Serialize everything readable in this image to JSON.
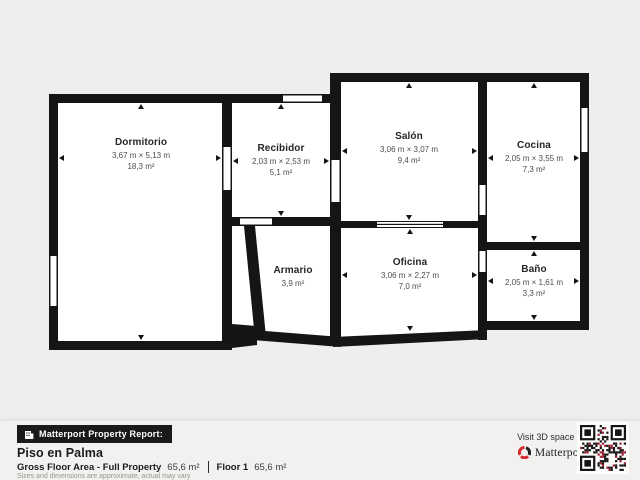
{
  "colors": {
    "background": "#efeeec",
    "wall": "#171514",
    "room_fill": "#ffffff",
    "brand_red": "#d7282f"
  },
  "rooms": [
    {
      "id": "dormitorio",
      "name": "Dormitorio",
      "dims": "3,67 m × 5,13 m",
      "area": "18,3 m²"
    },
    {
      "id": "recibidor",
      "name": "Recibidor",
      "dims": "2,03 m × 2,53 m",
      "area": "5,1 m²"
    },
    {
      "id": "salon",
      "name": "Salón",
      "dims": "3,06 m × 3,07 m",
      "area": "9,4 m²"
    },
    {
      "id": "cocina",
      "name": "Cocina",
      "dims": "2,05 m × 3,55 m",
      "area": "7,3 m²"
    },
    {
      "id": "armario",
      "name": "Armario",
      "dims": "",
      "area": "3,9 m²"
    },
    {
      "id": "oficina",
      "name": "Oficina",
      "dims": "3,06 m × 2,27 m",
      "area": "7,0 m²"
    },
    {
      "id": "bano",
      "name": "Baño",
      "dims": "2,05 m × 1,61 m",
      "area": "3,3 m²"
    }
  ],
  "footer": {
    "badge_label": "Matterport Property Report:",
    "title": "Piso en Palma",
    "gross_label": "Gross Floor Area - Full Property",
    "gross_value": "65,6 m²",
    "floor_label": "Floor 1",
    "floor_value": "65,6 m²",
    "disclaimer": "Sizes and dimensions are approximate, actual may vary",
    "visit_text": "Visit 3D space on",
    "brand_name": "Matterport"
  }
}
